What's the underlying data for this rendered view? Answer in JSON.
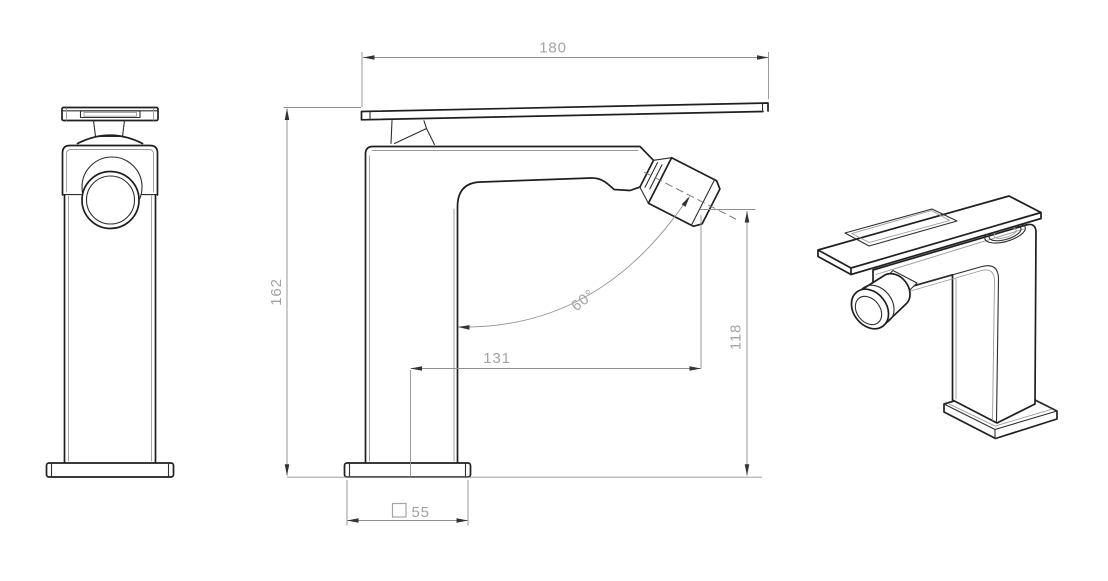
{
  "drawing": {
    "type": "faucet-technical-drawing",
    "background_color": "#ffffff",
    "object_line_color": "#1f1f1f",
    "dimension_line_color": "#8f8f8f",
    "dimension_text_color": "#a3a3a3",
    "dimensions": {
      "top_width": "180",
      "overall_height": "162",
      "spout_reach": "131",
      "outlet_height": "118",
      "outlet_angle": "60°",
      "base_size": "55",
      "base_size_symbol": "square"
    }
  }
}
